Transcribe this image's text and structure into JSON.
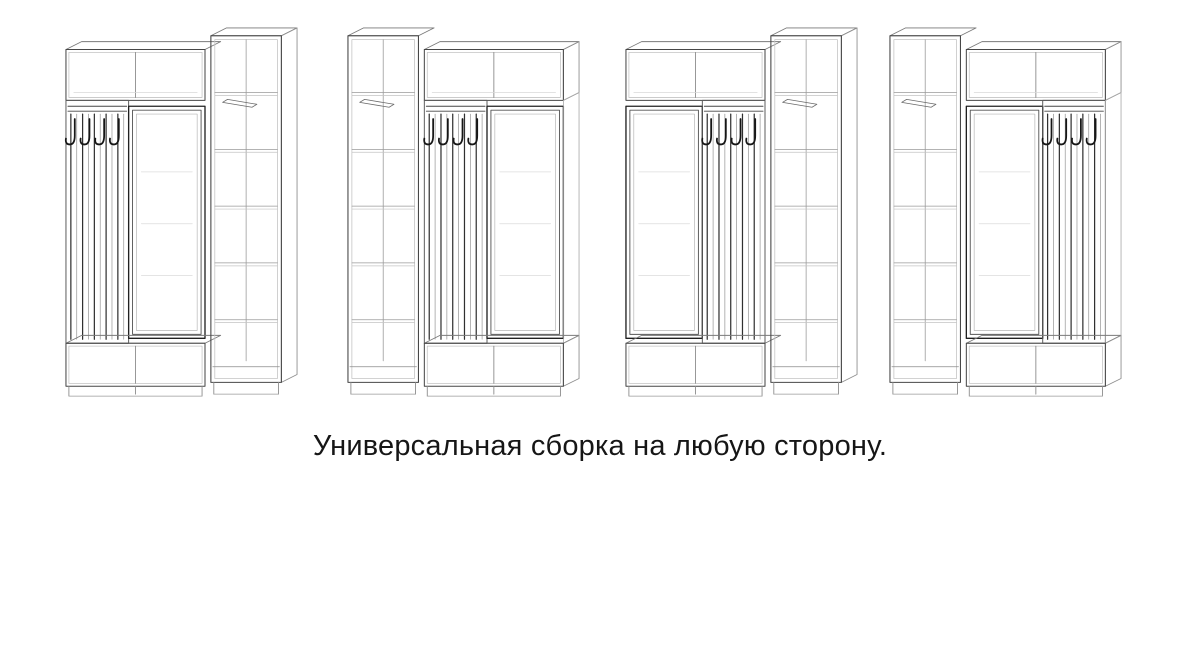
{
  "page": {
    "background": "#ffffff"
  },
  "caption": {
    "text": "Универсальная сборка на любую сторону."
  },
  "drawings": {
    "style": {
      "stroke_main": "#474747",
      "stroke_secondary": "#8a8a8a",
      "stroke_faint": "#c4c4c4",
      "stroke_dark_accent": "#161616"
    },
    "units": [
      {
        "label": "wardrobe-config-1",
        "layout": "hanger-mirror-cabinet"
      },
      {
        "label": "wardrobe-config-2",
        "layout": "cabinet-hanger-mirror"
      },
      {
        "label": "wardrobe-config-3",
        "layout": "mirror-hanger-cabinet"
      },
      {
        "label": "wardrobe-config-4",
        "layout": "cabinet-mirror-hanger"
      }
    ]
  }
}
